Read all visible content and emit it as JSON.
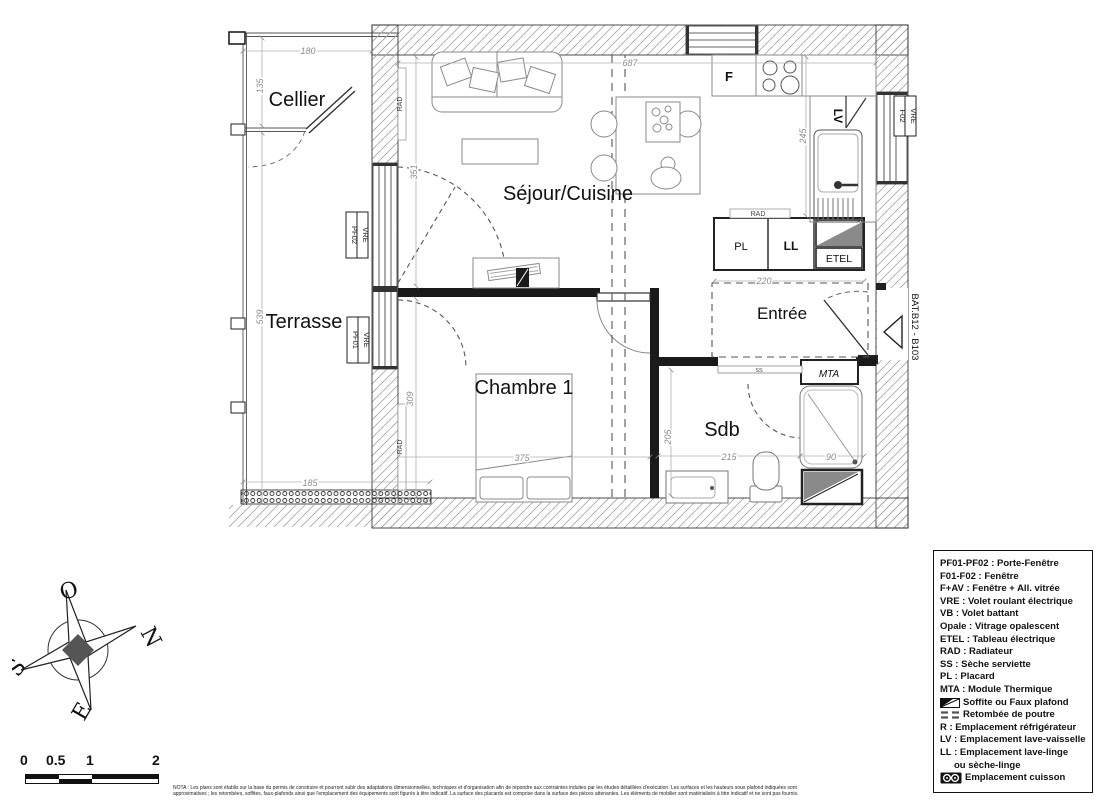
{
  "plan": {
    "rooms": {
      "cellier": "Cellier",
      "terrasse": "Terrasse",
      "sejour": "Séjour/Cuisine",
      "chambre": "Chambre 1",
      "entree": "Entrée",
      "sdb": "Sdb"
    },
    "dims": {
      "d180": "180",
      "d135": "135",
      "d539": "539",
      "d185": "185",
      "d687": "687",
      "d351": "351",
      "d245": "245",
      "d220": "220",
      "d309": "309",
      "d375": "375",
      "d205": "205",
      "d215": "215",
      "d90": "90"
    },
    "tags": {
      "f": "F",
      "lv": "LV",
      "pl": "PL",
      "ll": "LL",
      "etel": "ETEL",
      "rad": "RAD",
      "ss": "SS",
      "mta": "MTA",
      "bat": "BAT.B12 - B103",
      "pf02": "PF02",
      "pf01": "PF01",
      "f02": "F02",
      "vre": "VRE"
    }
  },
  "legend": {
    "items": [
      {
        "text": "PF01-PF02 : Porte-Fenêtre"
      },
      {
        "text": "F01-F02 : Fenêtre"
      },
      {
        "text": "F+AV : Fenêtre + All. vitrée"
      },
      {
        "text": "VRE : Volet roulant électrique"
      },
      {
        "text": "VB : Volet battant"
      },
      {
        "text": "Opale : Vitrage opalescent"
      },
      {
        "text": "ETEL : Tableau électrique"
      },
      {
        "text": "RAD : Radiateur"
      },
      {
        "text": "SS : Sèche serviette"
      },
      {
        "text": "PL : Placard"
      },
      {
        "text": "MTA : Module Thermique"
      },
      {
        "icon": "soffite",
        "text": "Soffite ou Faux plafond"
      },
      {
        "icon": "beam",
        "text": "Retombée de poutre"
      },
      {
        "text": "R : Emplacement réfrigérateur"
      },
      {
        "text": "LV : Emplacement lave-vaisselle"
      },
      {
        "text": "LL : Emplacement lave-linge",
        "text2": "ou sèche-linge"
      },
      {
        "icon": "cooktop",
        "text": "Emplacement cuisson"
      }
    ]
  },
  "compass": {
    "o": "O",
    "n": "N",
    "s": "S",
    "e": "E"
  },
  "scalebar": {
    "t0": "0",
    "t1": "0.5",
    "t2": "1",
    "t3": "2"
  },
  "nota": {
    "line1": "NOTA : Les plans sont établis sur la base du permis de construire et pourront subir des adaptations dimensionnelles, techniques et d'organisation afin de répondre aux contraintes induites par les études détaillées d'exécution. Les surfaces et les hauteurs sous plafond indiquées sont",
    "line2": "approximatives ; les retombées, soffites, faux-plafonds ainsi que l'emplacement des équipements sont figurés à titre indicatif. La surface des placards est comprise dans la surface des pièces attenantes. Les éléments de mobilier sont matérialisés à titre indicatif et ne sont pas fournis."
  }
}
